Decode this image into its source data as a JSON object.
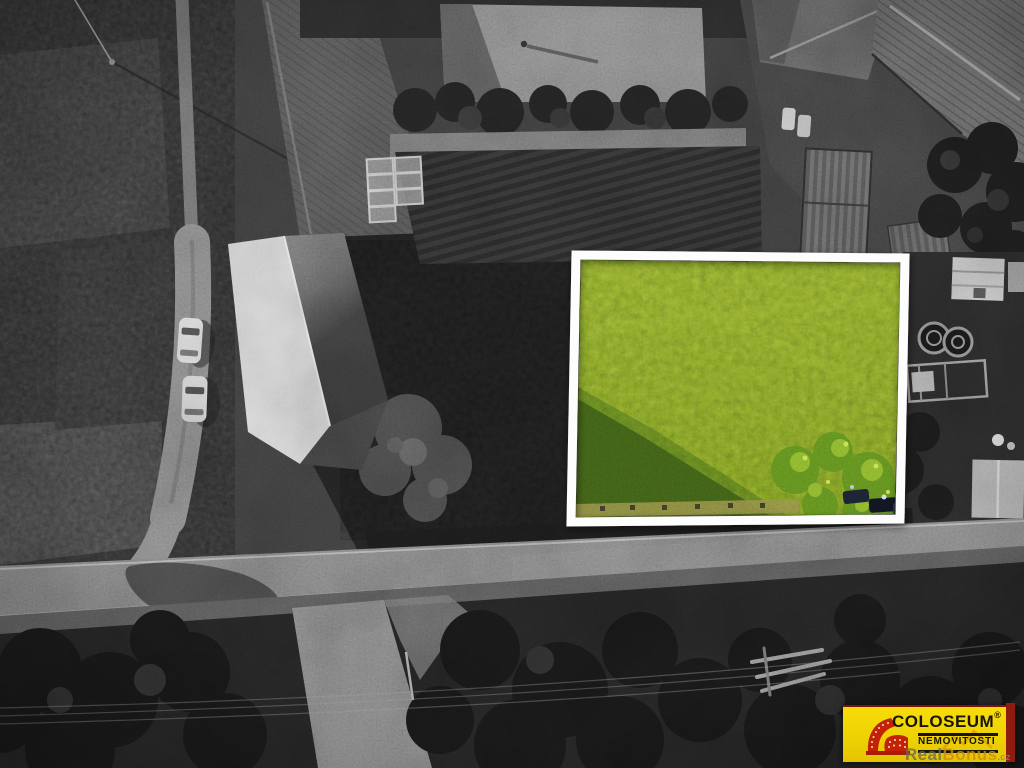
{
  "meta": {
    "description": "Aerial drone photograph of a village land parcel offered for sale; surroundings rendered in black and white, the offered parcel shown in colour inside a white frame"
  },
  "parcel_highlight": {
    "frame_color": "#fdfdfd",
    "grass_color": "#84a22b",
    "grass_shadow_color": "#3f5e18",
    "tree_color": "#5d8a1e",
    "dry_grass_color": "#8f8a45"
  },
  "photo_palette": {
    "monochrome_base": "#414141",
    "road_gray": "#868686",
    "barn_roof_light": "#dcdcdc",
    "dark_vegetation": "#1f1f1f"
  },
  "logo": {
    "brand": "COLOSEUM",
    "registered_mark": "®",
    "subtitle": "NEMOVITOSTI",
    "banner_color": "#efd203",
    "stripe_color": "#8f1a0e",
    "text_color": "#181504",
    "icon": "colosseum-icon",
    "icon_color": "#c32206",
    "watermark": {
      "text_real": "Real",
      "text_bonus": "Bonus",
      "text_suffix": ".cz",
      "real_color": "#6e6c54",
      "bonus_color": "#cd8d17"
    }
  }
}
